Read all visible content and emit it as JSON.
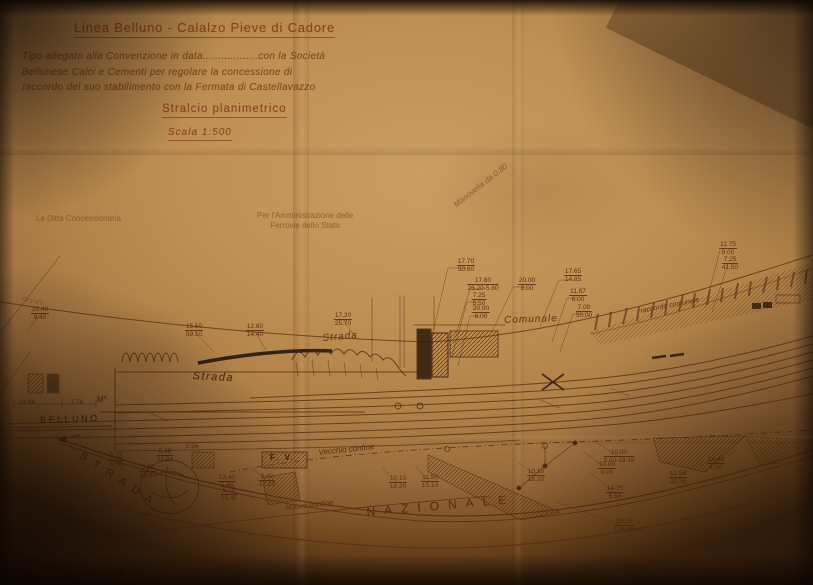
{
  "corner_mark": "7,",
  "title_block": {
    "line_title": "Linea Belluno - Calalzo Pieve di Cadore",
    "paragraph_lines": [
      "Tipo allegato alla Convenzione in data..................con la Società",
      "Bellunese Calci e Cementi per regolare la concessione di",
      "raccordo del suo stabilimento con la Fermata di Castellavazzo"
    ],
    "subtitle": "Stralcio planimetrico",
    "scale": "Scala 1:500"
  },
  "signature_block": {
    "left": "La Ditta Concessionaria",
    "right_line1": "Per l'Amministrazione delle",
    "right_line2": "Ferrovie dello Stato"
  },
  "handwritten_note": "Manovella da 0.80",
  "plan_labels": {
    "strada_cursive": "Strada",
    "strada_italic": "Strada",
    "comunale": "Comunale",
    "raccordo_comunale": "raccordo comunale",
    "belluno": "BELLUNO",
    "fv": "F. V.",
    "vecchio_confine": "Vecchio confine",
    "nuovo_confine": "Nuovo confine",
    "strada_arc": "STRADA",
    "nazionale": "NAZIONALE",
    "m_marker": "M°",
    "km_note": "21+06.60"
  },
  "footer_date": "Febbraio 1950",
  "colors": {
    "paper": "#c09154",
    "ink": "#7e3c16",
    "pencil": "#241910"
  },
  "measurements": [
    {
      "x": 466,
      "y": 258,
      "t": "17.70",
      "b": "50.60"
    },
    {
      "x": 483,
      "y": 277,
      "t": "17.80",
      "b": "26.20-5.80"
    },
    {
      "x": 527,
      "y": 277,
      "t": "20.00",
      "b": "8.00"
    },
    {
      "x": 573,
      "y": 268,
      "t": "17.65",
      "b": "14.85"
    },
    {
      "x": 479,
      "y": 292,
      "t": "7.25",
      "b": "5.50"
    },
    {
      "x": 481,
      "y": 305,
      "t": "20.00",
      "b": "8.00"
    },
    {
      "x": 578,
      "y": 288,
      "t": "11.87",
      "b": "6.00"
    },
    {
      "x": 584,
      "y": 304,
      "t": "7.00",
      "b": "50.00"
    },
    {
      "x": 728,
      "y": 241,
      "t": "11.75",
      "b": "9.00"
    },
    {
      "x": 730,
      "y": 256,
      "t": "7.25",
      "b": "41.50"
    },
    {
      "x": 194,
      "y": 323,
      "t": "15.50",
      "b": "59.10"
    },
    {
      "x": 255,
      "y": 323,
      "t": "12.60",
      "b": "14.40"
    },
    {
      "x": 343,
      "y": 312,
      "t": "17.20",
      "b": "25.70"
    },
    {
      "x": 40,
      "y": 306,
      "t": "20.40",
      "b": "9.45"
    },
    {
      "x": 27,
      "y": 399,
      "t": "14.84",
      "b": ""
    },
    {
      "x": 77,
      "y": 399,
      "t": "7.76",
      "b": ""
    },
    {
      "x": 267,
      "y": 473,
      "t": "9.40",
      "b": "17.20"
    },
    {
      "x": 398,
      "y": 475,
      "t": "10.10",
      "b": "18.20"
    },
    {
      "x": 430,
      "y": 474,
      "t": "11.50",
      "b": "15.10"
    },
    {
      "x": 536,
      "y": 468,
      "t": "10.10",
      "b": "18.20"
    },
    {
      "x": 619,
      "y": 449,
      "t": "10.00",
      "b": "3.50-19.18"
    },
    {
      "x": 607,
      "y": 461,
      "t": "10.00",
      "b": "0.00"
    },
    {
      "x": 615,
      "y": 485,
      "t": "14.75",
      "b": "5.50"
    },
    {
      "x": 678,
      "y": 470,
      "t": "12.56",
      "b": "22.56"
    },
    {
      "x": 716,
      "y": 456,
      "t": "14.40",
      "b": "1.00"
    },
    {
      "x": 624,
      "y": 518,
      "t": "20.75",
      "b": "124.05"
    },
    {
      "x": 116,
      "y": 453,
      "t": "0.78",
      "b": "5.00"
    },
    {
      "x": 165,
      "y": 448,
      "t": "5.46",
      "b": "31.24"
    },
    {
      "x": 148,
      "y": 464,
      "t": "5.60",
      "b": "18.50"
    },
    {
      "x": 192,
      "y": 443,
      "t": "0.56",
      "b": ""
    },
    {
      "x": 227,
      "y": 474,
      "t": "13.40",
      "b": "8.40"
    },
    {
      "x": 229,
      "y": 487,
      "t": "5.20",
      "b": "15.45"
    }
  ]
}
